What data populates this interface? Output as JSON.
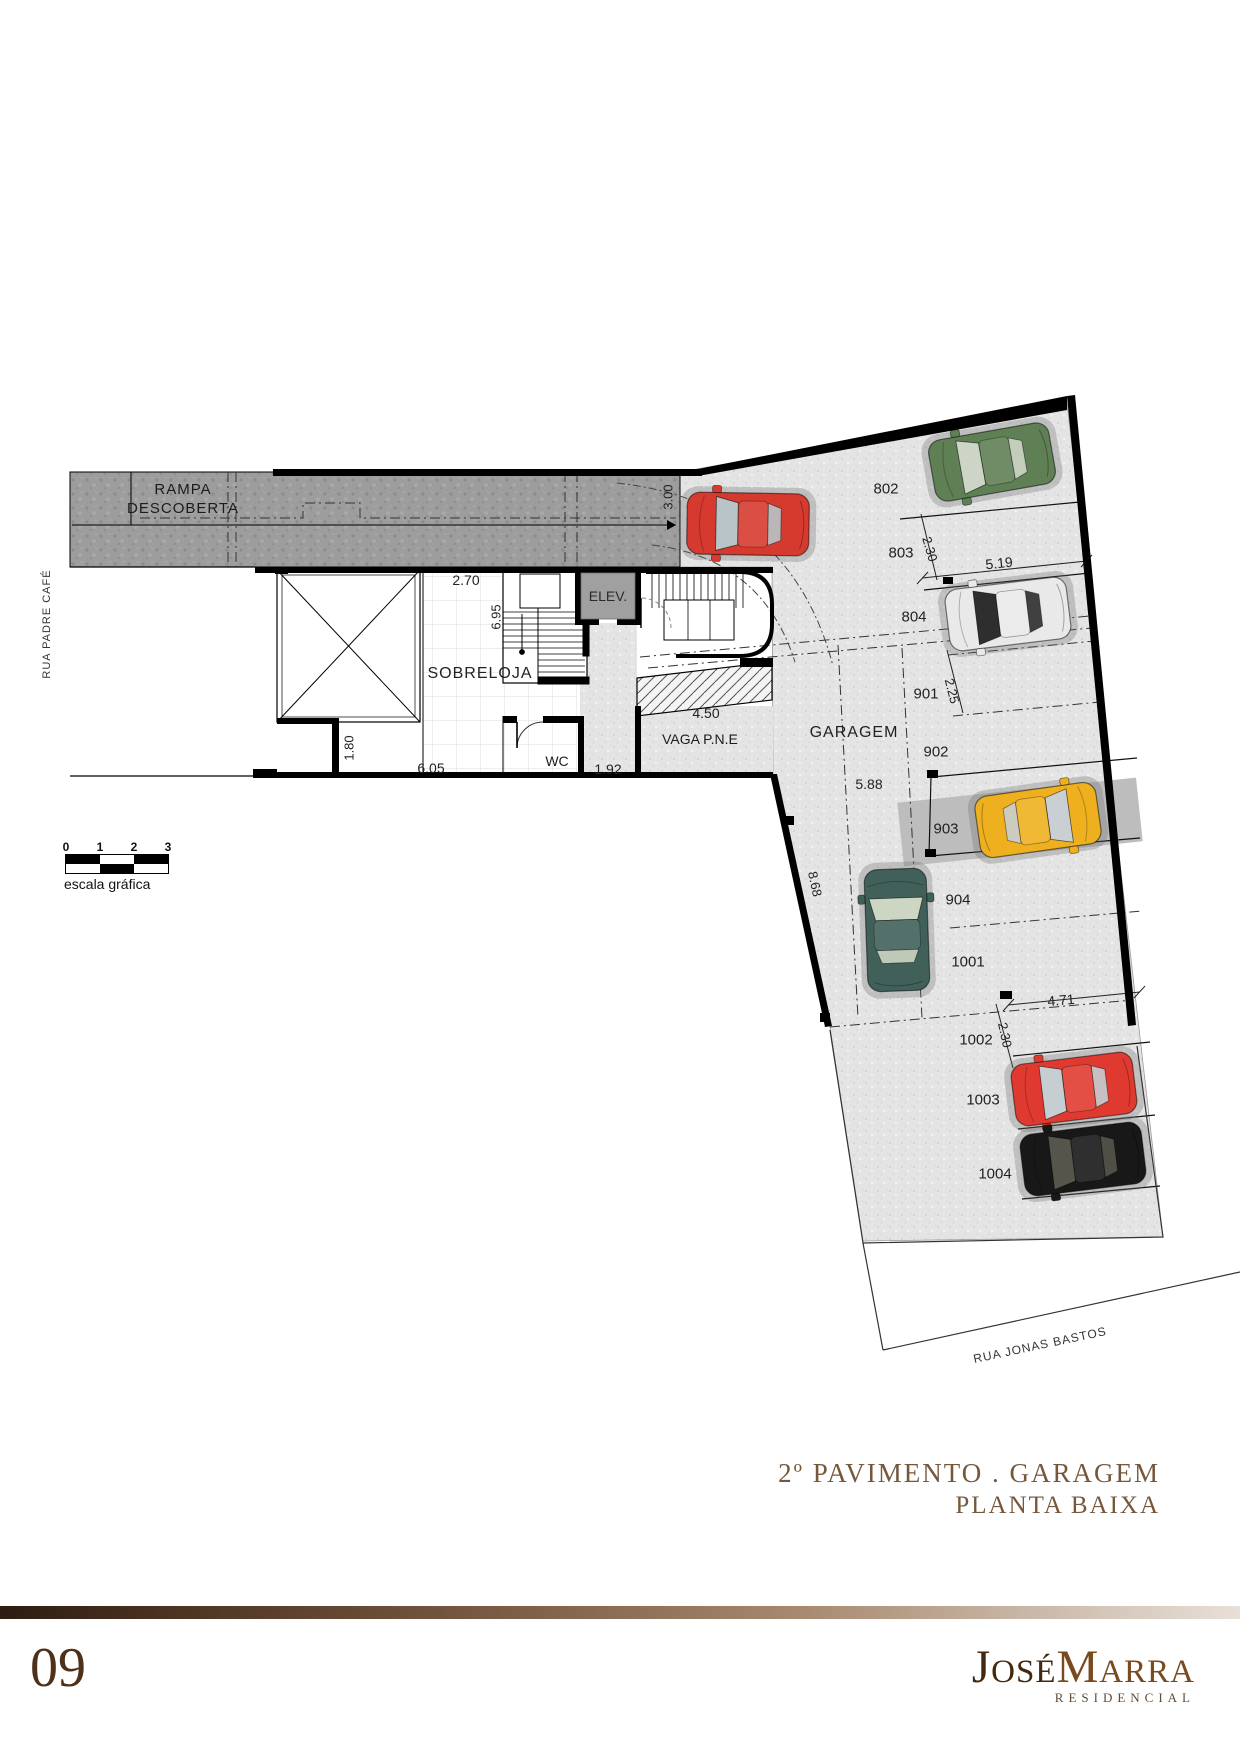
{
  "streets": {
    "left": "RUA PADRE CAFÉ",
    "bottom_right": "RUA JONAS BASTOS"
  },
  "areas": {
    "ramp_line1": "RAMPA",
    "ramp_line2": "DESCOBERTA",
    "mezzanine": "SOBRELOJA",
    "elevator": "ELEV.",
    "wc": "WC",
    "accessible_spot": "VAGA P.N.E",
    "garage": "GARAGEM"
  },
  "spots": [
    "802",
    "803",
    "804",
    "901",
    "902",
    "903",
    "904",
    "1001",
    "1002",
    "1003",
    "1004"
  ],
  "dims": {
    "ramp_width": "3.00",
    "mezz_width": "2.70",
    "mezz_depth": "6.95",
    "void_gap": "1.80",
    "mezz_len": "6.05",
    "corridor": "1.92",
    "vaga_len": "4.50",
    "spot_w_top": "2.30",
    "spot_len_top": "5.19",
    "spot_w_901": "2.25",
    "lane_w": "5.88",
    "wall_len": "8.68",
    "spot_len_1001": "4.71",
    "spot_w_1002": "2.30"
  },
  "scale_bar": {
    "ticks": [
      "0",
      "1",
      "2",
      "3"
    ],
    "caption": "escala gráfica"
  },
  "title_block": {
    "line1": "2º PAVIMENTO . GARAGEM",
    "line2": "PLANTA BAIXA"
  },
  "footer": {
    "page_number": "09",
    "brand_first": "José",
    "brand_last": "Marra",
    "brand_sub": "RESIDENCIAL"
  },
  "colors": {
    "accent_brown": "#75583c",
    "ramp_gray": "#9d9d9d",
    "floor_gray": "#e4e4e4",
    "wall_black": "#000000"
  },
  "cars": [
    {
      "location": "ramp-turn",
      "body": "#d63a2e",
      "glass": "#b9c4c8"
    },
    {
      "location": "802",
      "body": "#5f7f55",
      "glass": "#cdd6c6"
    },
    {
      "location": "804",
      "body": "#e9e9e9",
      "glass": "#2e2e2e"
    },
    {
      "location": "903",
      "body": "#eeb01f",
      "glass": "#c9cfd2"
    },
    {
      "location": "lane",
      "body": "#41605a",
      "glass": "#ccd6c2"
    },
    {
      "location": "1003",
      "body": "#e03a30",
      "glass": "#c6ced2"
    },
    {
      "location": "1004",
      "body": "#181818",
      "glass": "#55554c"
    }
  ]
}
